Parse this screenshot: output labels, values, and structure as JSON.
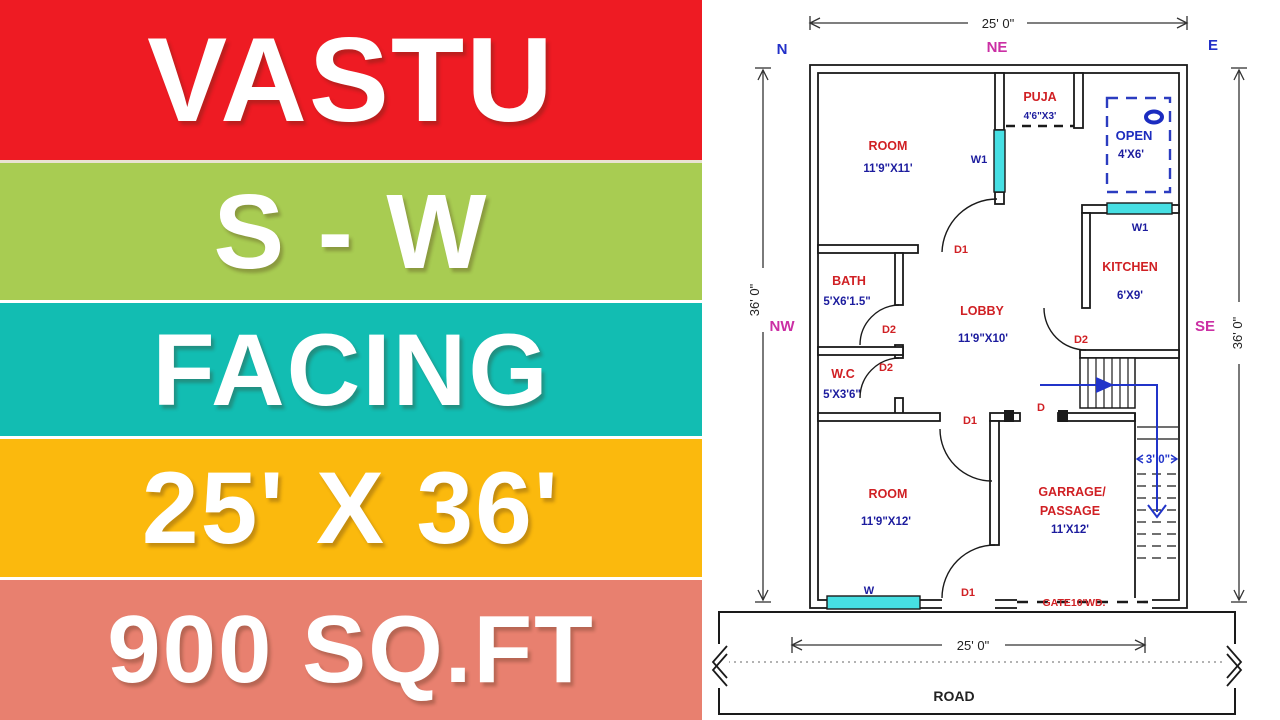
{
  "left_panel": {
    "bands": [
      {
        "label": "VASTU",
        "bg": "#ee1b23"
      },
      {
        "label": "S - W",
        "bg": "#a8cc52"
      },
      {
        "label": "FACING",
        "bg": "#12bdb2"
      },
      {
        "label": "25' X 36'",
        "bg": "#fbb90d"
      },
      {
        "label": "900 SQ.FT",
        "bg": "#e8806f"
      }
    ]
  },
  "plan": {
    "compass": {
      "n": "N",
      "ne": "NE",
      "e": "E",
      "nw": "NW",
      "se": "SE",
      "w": "W",
      "sw": "SW",
      "s": "S"
    },
    "dims": {
      "top": "25' 0\"",
      "bottom": "25' 0\"",
      "left": "36' 0\"",
      "right": "36' 0\"",
      "stair": "3' 0\""
    },
    "rooms": {
      "room_top": {
        "name": "ROOM",
        "size": "11'9\"X11'"
      },
      "puja": {
        "name": "PUJA",
        "size": "4'6\"X3'"
      },
      "open": {
        "name": "OPEN",
        "size": "4'X6'"
      },
      "kitchen": {
        "name": "KITCHEN",
        "size": "6'X9'"
      },
      "bath": {
        "name": "BATH",
        "size": "5'X6'1.5\""
      },
      "lobby": {
        "name": "LOBBY",
        "size": "11'9\"X10'"
      },
      "wc": {
        "name": "W.C",
        "size": "5'X3'6\""
      },
      "room_bottom": {
        "name": "ROOM",
        "size": "11'9\"X12'"
      },
      "garage": {
        "line1": "GARRAGE/",
        "line2": "PASSAGE",
        "size": "11'X12'"
      }
    },
    "openings": {
      "w1": "W1",
      "w": "W",
      "d": "D",
      "d1": "D1",
      "d2": "D2"
    },
    "gate_label": "GATE10'WD.",
    "road_label": "ROAD"
  },
  "colors": {
    "band_red": "#ee1b23",
    "band_green": "#a8cc52",
    "band_teal": "#12bdb2",
    "band_yellow": "#fbb90d",
    "band_salmon": "#e8806f",
    "room_name_red": "#d02024",
    "dimension_navy": "#1c1c9e",
    "compass_blue": "#2230c8",
    "compass_magenta": "#cb2fa4",
    "window_cyan": "#46dfe3",
    "stair_arrow_blue": "#2134c9"
  }
}
